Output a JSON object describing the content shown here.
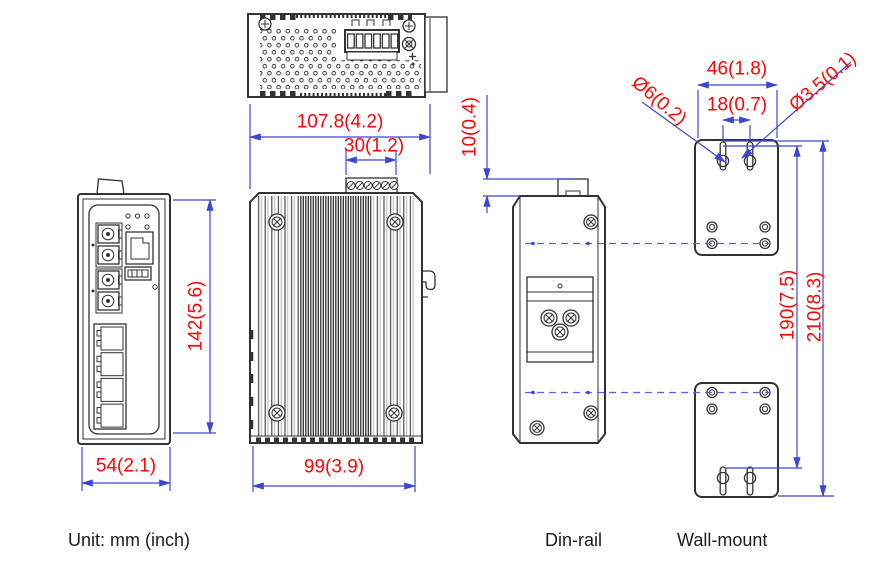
{
  "title_note": "Mechanical dimension drawing of an industrial switch",
  "colors": {
    "dimension_text": "#f90606",
    "dimension_line": "#3d46cf",
    "dashed_line": "#5c5cf0",
    "outline": "#333333"
  },
  "dimensions": {
    "top_width": "107.8(4.2)",
    "terminal_block_width": "30(1.2)",
    "front_height": "142(5.6)",
    "front_width": "54(2.1)",
    "rear_width": "99(3.9)",
    "clip_offset": "10(0.4)",
    "plate_width": "46(1.8)",
    "keyhole_spacing": "18(0.7)",
    "keyhole_diameter": "Ø6(0.2)",
    "slot_diameter": "Ø3.5(0.1)",
    "mount_hole_span": "190(7.5)",
    "plate_height": "210(8.3)"
  },
  "footer": {
    "unit_note": "Unit: mm (inch)",
    "din_rail_caption": "Din-rail",
    "wall_mount_caption": "Wall-mount"
  }
}
